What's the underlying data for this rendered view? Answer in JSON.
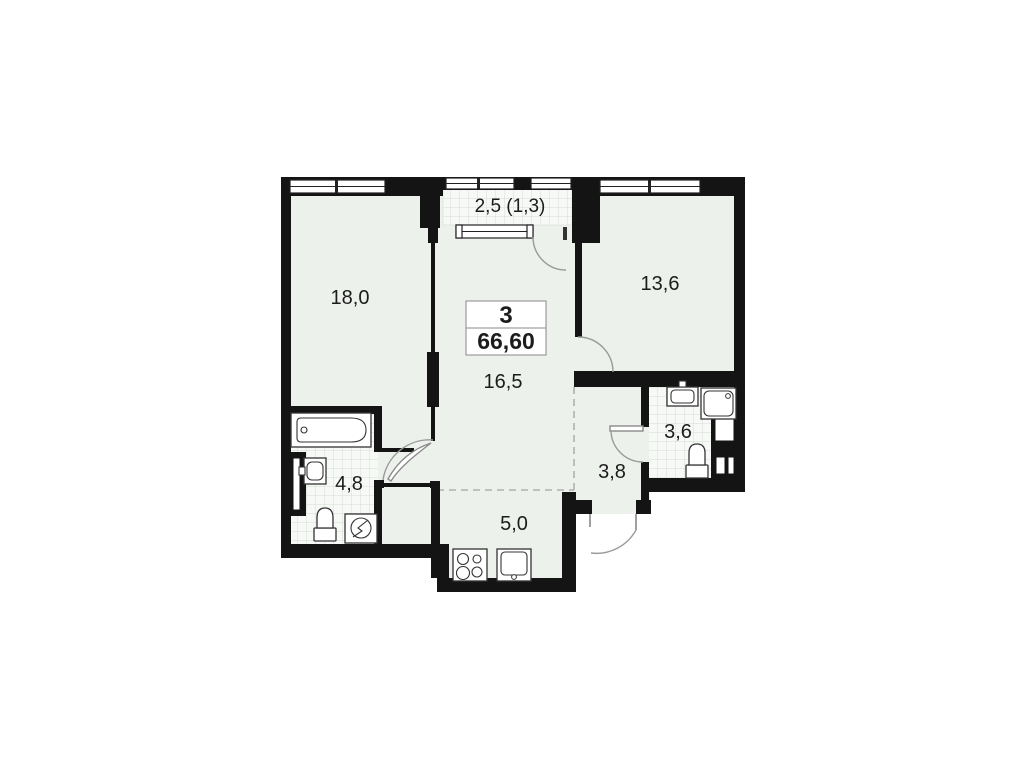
{
  "unit": {
    "rooms_count": "3",
    "total_area": "66,60"
  },
  "rooms": [
    {
      "id": "living-room",
      "area": "18,0"
    },
    {
      "id": "balcony",
      "area": "2,5 (1,3)"
    },
    {
      "id": "bedroom",
      "area": "13,6"
    },
    {
      "id": "hall",
      "area": "16,5"
    },
    {
      "id": "bathroom",
      "area": "4,8"
    },
    {
      "id": "wc",
      "area": "3,6"
    },
    {
      "id": "corridor",
      "area": "3,8"
    },
    {
      "id": "kitchen",
      "area": "5,0"
    }
  ],
  "fixtures": [
    "bathtub",
    "bathroom-sink",
    "toilet",
    "washing-machine",
    "wc-sink",
    "shower-tray",
    "wc-toilet",
    "kitchen-stove",
    "kitchen-sink",
    "ventilation-shaft"
  ],
  "colors": {
    "wall": "#141414",
    "room_fill": "#edf1ec",
    "hatch_bg": "#f7f9f6",
    "hatch_line": "#d7ddd5",
    "arc": "#9a9a9a",
    "dashed": "#b0b0b0"
  }
}
